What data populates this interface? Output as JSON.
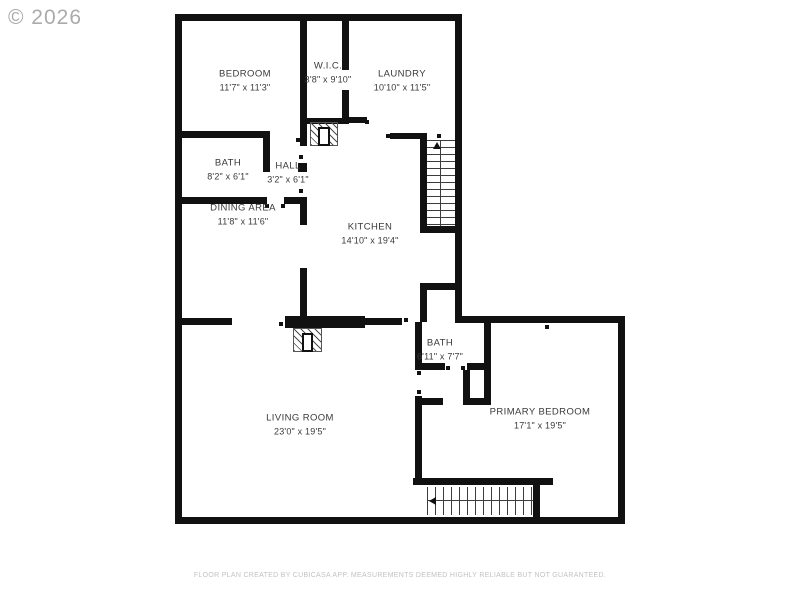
{
  "watermark": "© 2026",
  "footer": "FLOOR PLAN CREATED BY CUBICASA APP. MEASUREMENTS DEEMED HIGHLY RELIABLE BUT NOT GUARANTEED.",
  "colors": {
    "wall": "#111111",
    "room_text": "#3a3a3a",
    "watermark": "#9c9c9c",
    "footer_text": "#c2c2c2",
    "background": "#ffffff"
  },
  "rooms": [
    {
      "name": "BEDROOM",
      "dims": "11'7\" x 11'3\""
    },
    {
      "name": "W.I.C.",
      "dims": "3'8\" x 9'10\""
    },
    {
      "name": "LAUNDRY",
      "dims": "10'10\" x 11'5\""
    },
    {
      "name": "BATH",
      "dims": "8'2\" x 6'1\""
    },
    {
      "name": "HALL",
      "dims": "3'2\" x 6'1\""
    },
    {
      "name": "KITCHEN",
      "dims": "14'10\" x 19'4\""
    },
    {
      "name": "DINING AREA",
      "dims": "11'8\" x 11'6\""
    },
    {
      "name": "LIVING ROOM",
      "dims": "23'0\" x 19'5\""
    },
    {
      "name": "BATH",
      "dims": "6'11\" x 7'7\""
    },
    {
      "name": "PRIMARY BEDROOM",
      "dims": "17'1\" x 19'5\""
    }
  ]
}
